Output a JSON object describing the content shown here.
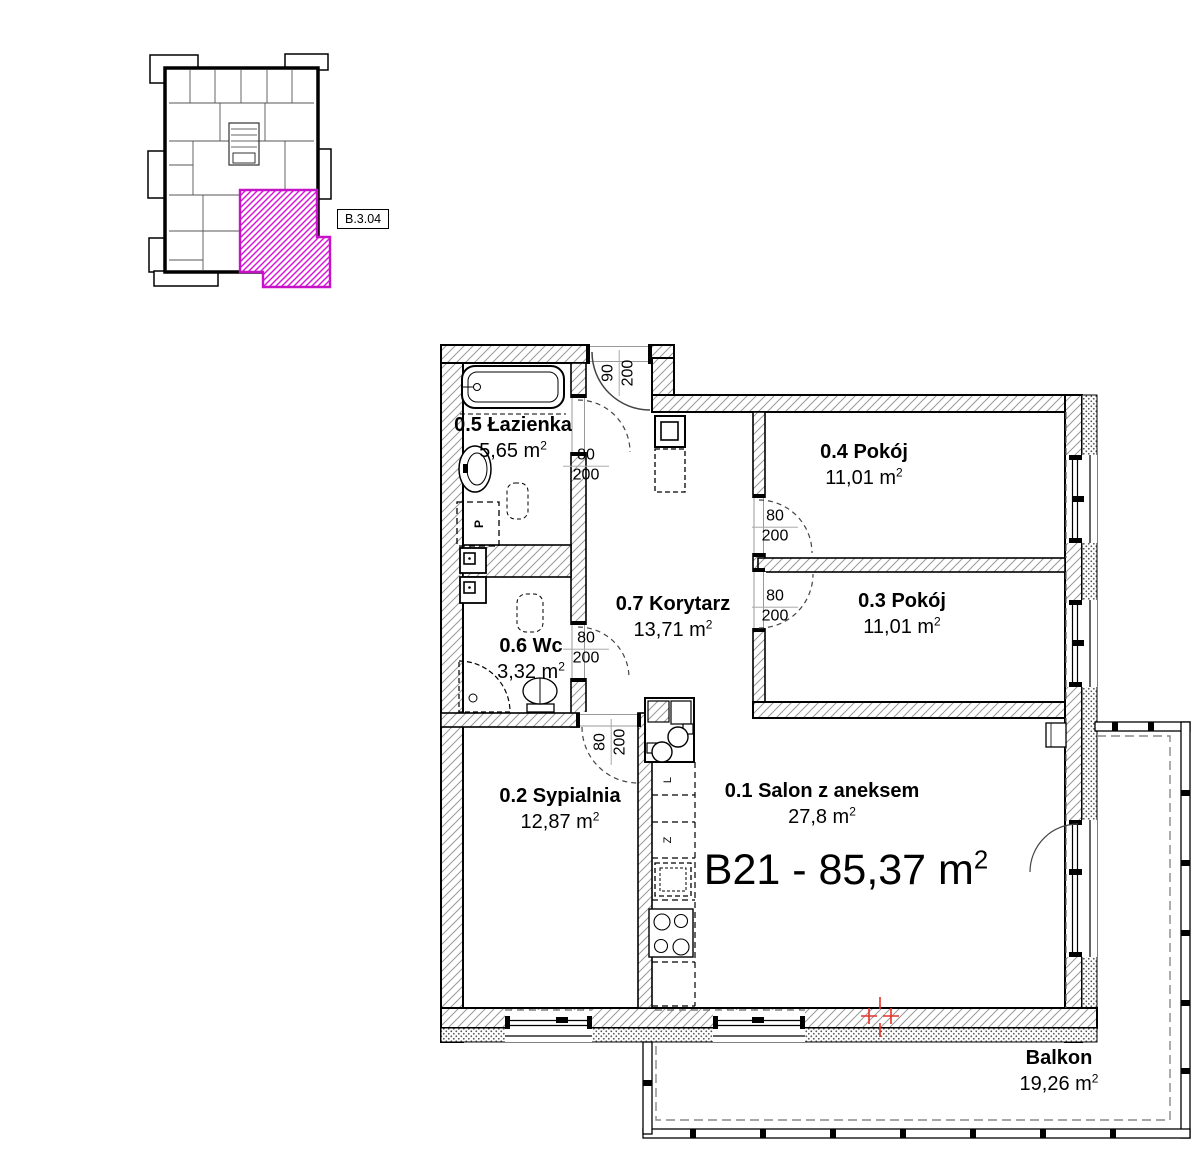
{
  "overview": {
    "unit_box_label": "B.3.04"
  },
  "apartment": {
    "title": "B21 - 85,37 m²"
  },
  "rooms": {
    "salon": {
      "name": "0.1 Salon z aneksem",
      "area": "27,8 m²"
    },
    "bedroom": {
      "name": "0.2 Sypialnia",
      "area": "12,87 m²"
    },
    "room3": {
      "name": "0.3 Pokój",
      "area": "11,01 m²"
    },
    "room4": {
      "name": "0.4 Pokój",
      "area": "11,01 m²"
    },
    "bathroom": {
      "name": "0.5 Łazienka",
      "area": "5,65 m²"
    },
    "wc": {
      "name": "0.6 Wc",
      "area": "3,32 m²"
    },
    "corridor": {
      "name": "0.7 Korytarz",
      "area": "13,71 m²"
    },
    "balcony": {
      "name": "Balkon",
      "area": "19,26 m²"
    }
  },
  "doors": {
    "entrance": {
      "width": "90",
      "height": "200"
    },
    "bathroom": {
      "width": "80",
      "height": "200"
    },
    "wc": {
      "width": "80",
      "height": "200"
    },
    "bedroom": {
      "width": "80",
      "height": "200"
    },
    "room4": {
      "width": "80",
      "height": "200"
    },
    "room3": {
      "width": "80",
      "height": "200"
    }
  },
  "appliances": {
    "washer": "P",
    "fridge": "L",
    "dishwasher": "Z"
  },
  "colors": {
    "highlight": "#cc12cc",
    "marker": "#e53228"
  }
}
